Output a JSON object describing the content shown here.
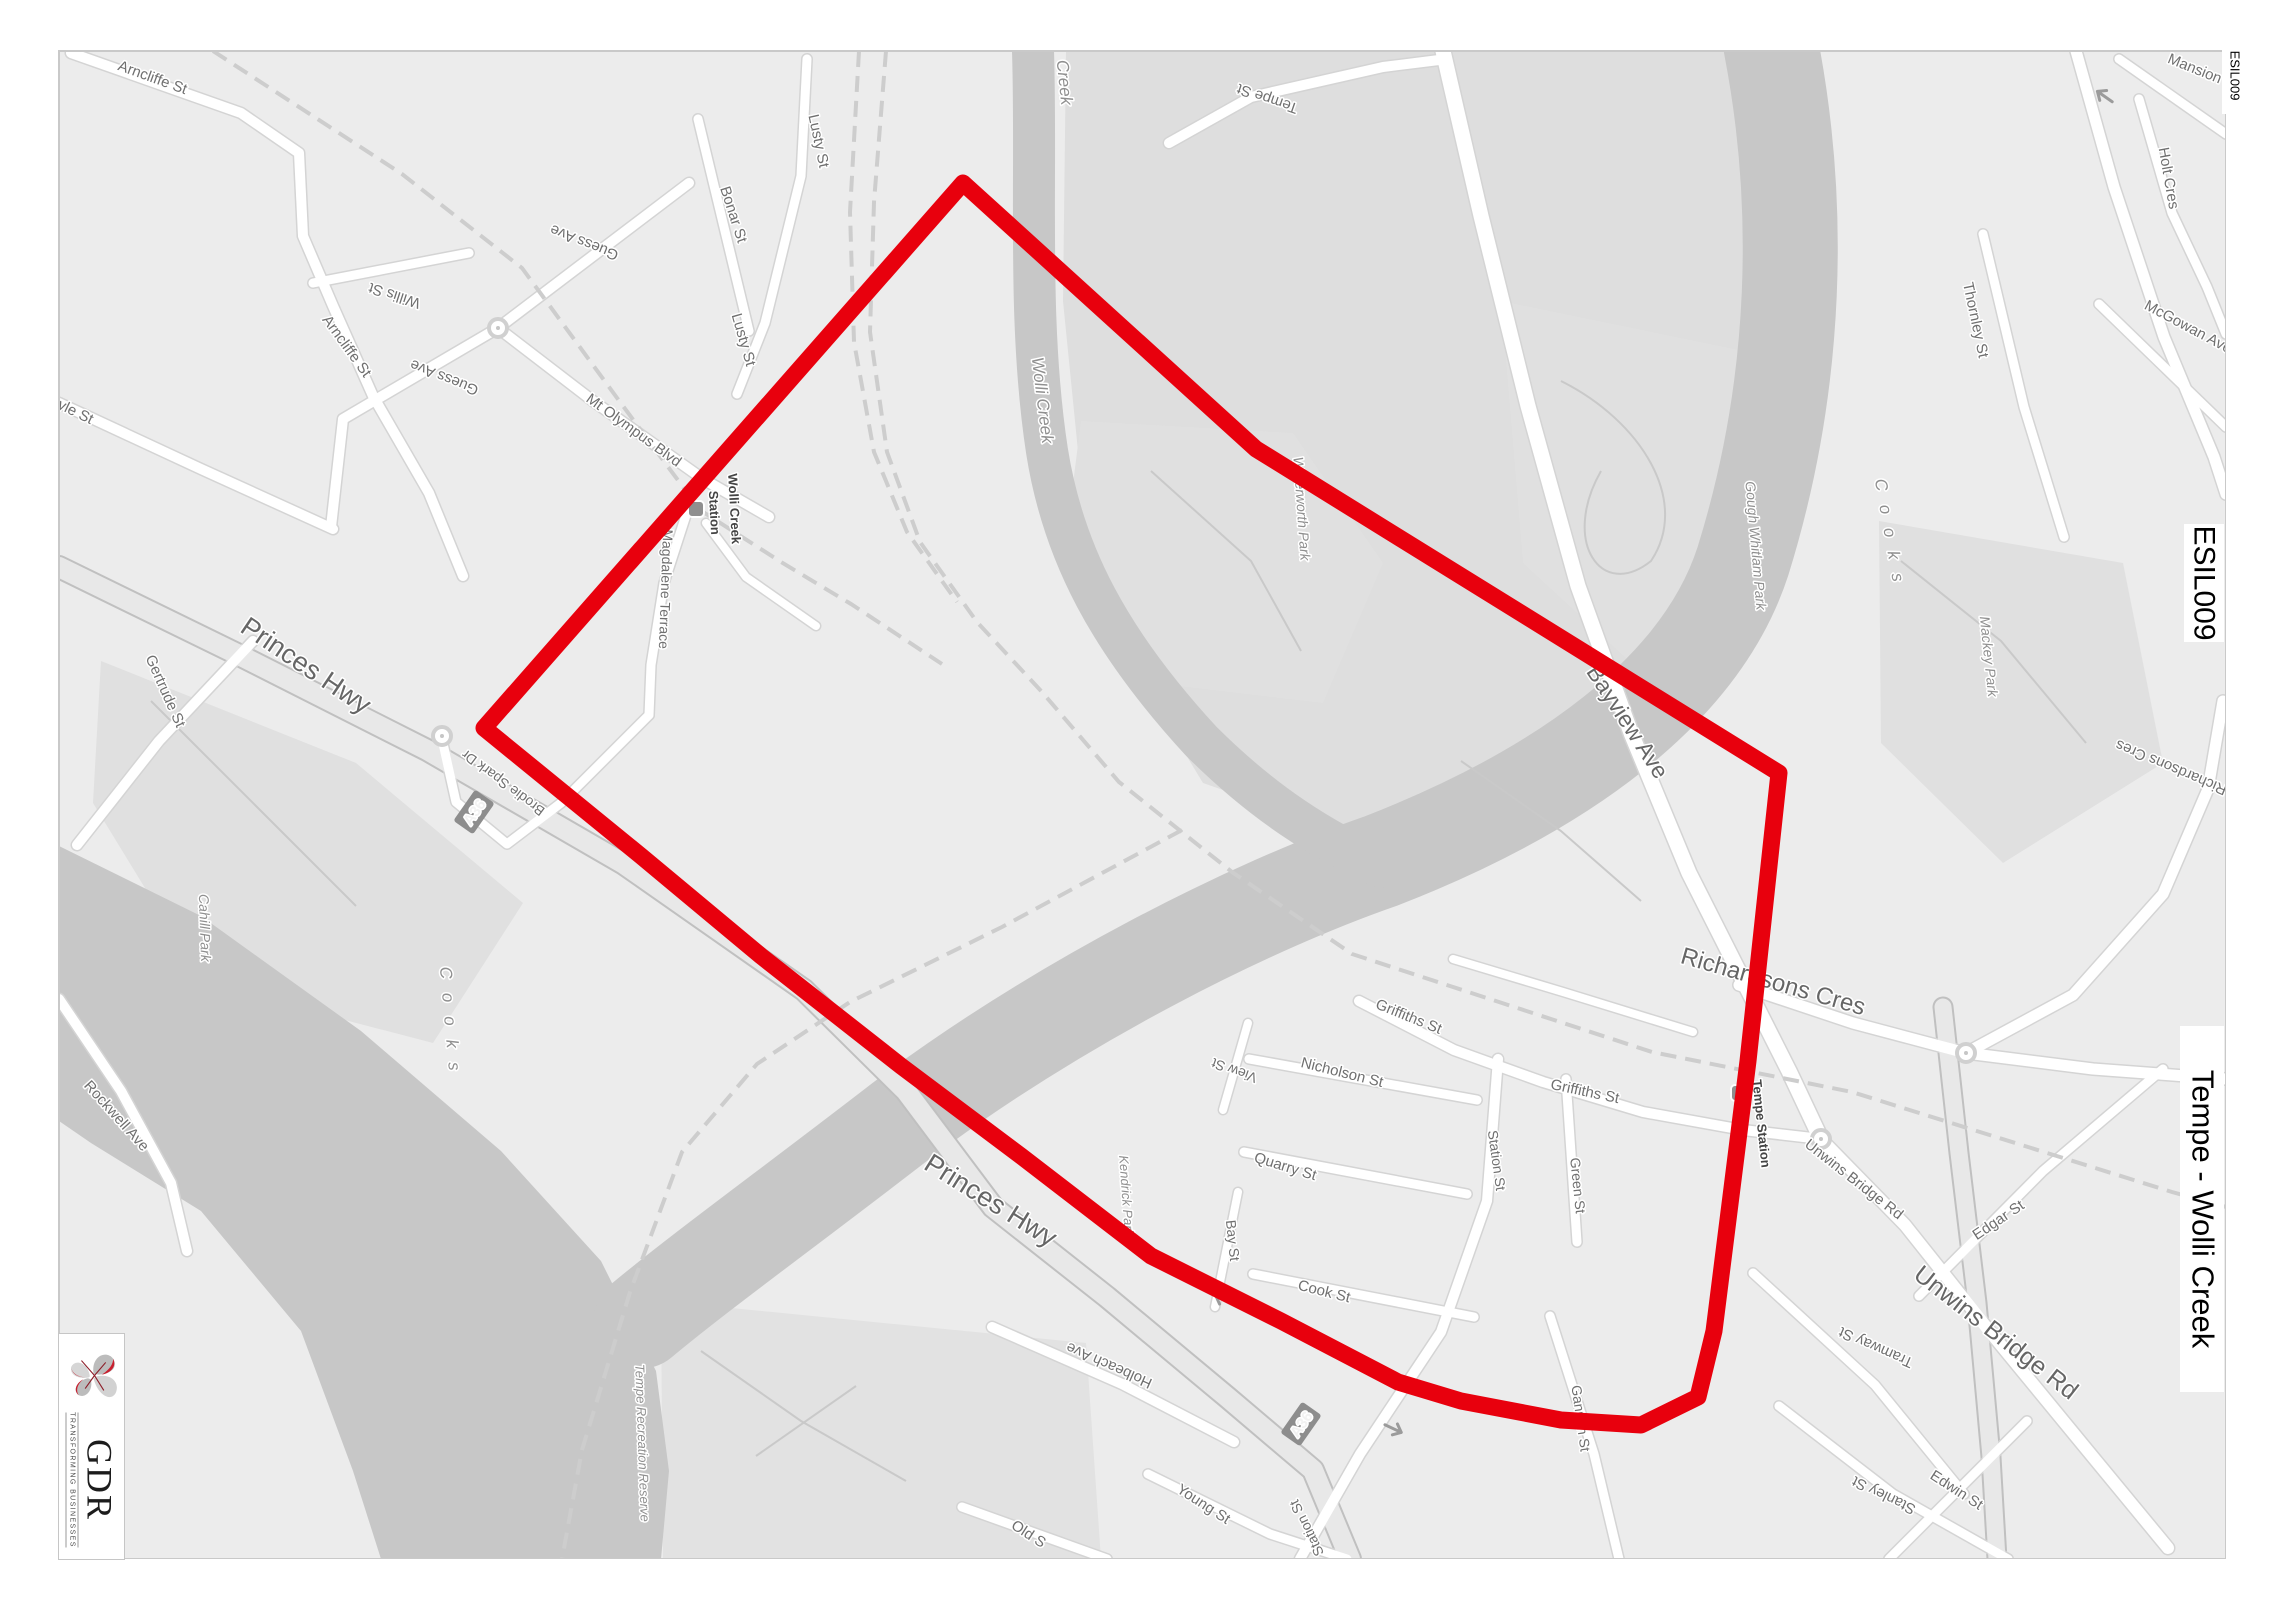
{
  "document": {
    "type": "map-extract"
  },
  "overlays": {
    "corner_code": "ESIL009",
    "side_code": "ESIL009",
    "side_title": "Tempe - Wolli Creek"
  },
  "logo": {
    "monogram": "GDR",
    "tagline": "TRANSFORMING BUSINESSES",
    "accent_color": "#c8202f"
  },
  "selection": {
    "color": "#e8000d",
    "stroke_width": 17,
    "points": [
      [
        483,
        727
      ],
      [
        962,
        182
      ],
      [
        1255,
        448
      ],
      [
        1778,
        772
      ],
      [
        1747,
        1060
      ],
      [
        1713,
        1330
      ],
      [
        1697,
        1396
      ],
      [
        1640,
        1424
      ],
      [
        1560,
        1419
      ],
      [
        1460,
        1400
      ],
      [
        1397,
        1381
      ],
      [
        1280,
        1320
      ],
      [
        1150,
        1255
      ],
      [
        1020,
        1155
      ],
      [
        900,
        1065
      ],
      [
        760,
        955
      ],
      [
        640,
        855
      ],
      [
        483,
        727
      ]
    ]
  },
  "route_badges": [
    {
      "label": "A36",
      "x": 473,
      "y": 811,
      "rot": -55
    },
    {
      "label": "A36",
      "x": 1300,
      "y": 1423,
      "rot": -55
    }
  ],
  "map_icons": [
    {
      "name": "roundabout-icon",
      "x": 497,
      "y": 327
    },
    {
      "name": "roundabout-icon",
      "x": 441,
      "y": 735
    },
    {
      "name": "roundabout-icon",
      "x": 1820,
      "y": 1138
    },
    {
      "name": "roundabout-icon",
      "x": 1965,
      "y": 1052
    },
    {
      "name": "station-marker-icon",
      "x": 695,
      "y": 508
    },
    {
      "name": "station-marker-icon",
      "x": 1738,
      "y": 1092
    },
    {
      "name": "oneway-arrow-icon",
      "x": 2103,
      "y": 95,
      "rot": 215
    },
    {
      "name": "oneway-arrow-icon",
      "x": 1222,
      "y": 1298,
      "rot": 205
    },
    {
      "name": "oneway-arrow-icon",
      "x": 1393,
      "y": 1428,
      "rot": 25
    }
  ],
  "map_labels": [
    {
      "t": "Arncliffe St",
      "x": 150,
      "y": 81,
      "r": 20,
      "s": 15
    },
    {
      "t": "Arncliffe St",
      "x": 342,
      "y": 348,
      "r": 54,
      "s": 15
    },
    {
      "t": "Willis St",
      "x": 395,
      "y": 290,
      "r": 198,
      "s": 15
    },
    {
      "t": "Guess Ave",
      "x": 585,
      "y": 237,
      "r": 202,
      "s": 15
    },
    {
      "t": "Guess Ave",
      "x": 445,
      "y": 372,
      "r": 202,
      "s": 15
    },
    {
      "t": "Bonar St",
      "x": 728,
      "y": 215,
      "r": 72,
      "s": 15
    },
    {
      "t": "Lusty St",
      "x": 813,
      "y": 141,
      "r": 78,
      "s": 15
    },
    {
      "t": "Lusty St",
      "x": 738,
      "y": 340,
      "r": 74,
      "s": 15
    },
    {
      "t": "Mt Olympus Blvd",
      "x": 630,
      "y": 433,
      "r": 36,
      "s": 15
    },
    {
      "t": "Wolli Creek",
      "x": 729,
      "y": 508,
      "r": 87,
      "s": 13,
      "st": "station"
    },
    {
      "t": "Station",
      "x": 709,
      "y": 512,
      "r": 87,
      "s": 13,
      "st": "station"
    },
    {
      "t": "Magdalene Terrace",
      "x": 660,
      "y": 588,
      "r": 92,
      "s": 14
    },
    {
      "t": "Brodie Spark Dr",
      "x": 505,
      "y": 778,
      "r": 217,
      "s": 14
    },
    {
      "t": "Argyle St",
      "x": 62,
      "y": 410,
      "r": 26,
      "s": 15
    },
    {
      "t": "Gertrude St",
      "x": 160,
      "y": 692,
      "r": 66,
      "s": 15
    },
    {
      "t": "Princes Hwy",
      "x": 300,
      "y": 672,
      "r": 34,
      "s": 27,
      "st": "big"
    },
    {
      "t": "Princes Hwy",
      "x": 985,
      "y": 1207,
      "r": 32,
      "s": 27,
      "st": "big"
    },
    {
      "t": "Cahill Park",
      "x": 199,
      "y": 927,
      "r": 88,
      "s": 14,
      "st": "place"
    },
    {
      "t": "Cooks",
      "x": 444,
      "y": 1025,
      "r": 85,
      "s": 17,
      "st": "water",
      "ls": 14
    },
    {
      "t": "Rockwell Ave",
      "x": 112,
      "y": 1118,
      "r": 48,
      "s": 15
    },
    {
      "t": "Creek",
      "x": 1058,
      "y": 82,
      "r": 84,
      "s": 17,
      "st": "water"
    },
    {
      "t": "Wolli Creek",
      "x": 1036,
      "y": 400,
      "r": 83,
      "s": 17,
      "st": "water"
    },
    {
      "t": "Tempe St",
      "x": 1268,
      "y": 93,
      "r": 199,
      "s": 15
    },
    {
      "t": "Waterworth Park",
      "x": 1296,
      "y": 508,
      "r": 86,
      "s": 14,
      "st": "place"
    },
    {
      "t": "Gough Whitlam Park",
      "x": 1750,
      "y": 545,
      "r": 85,
      "s": 14,
      "st": "place"
    },
    {
      "t": "Mackey Park",
      "x": 1983,
      "y": 656,
      "r": 84,
      "s": 14,
      "st": "place"
    },
    {
      "t": "Bayview Ave",
      "x": 1620,
      "y": 725,
      "r": 57,
      "s": 23,
      "st": "big"
    },
    {
      "t": "Richardsons Cres",
      "x": 1770,
      "y": 988,
      "r": 16,
      "s": 24,
      "st": "big"
    },
    {
      "t": "Richardsons Cres",
      "x": 2172,
      "y": 762,
      "r": 203,
      "s": 15
    },
    {
      "t": "Thornley St",
      "x": 1970,
      "y": 320,
      "r": 78,
      "s": 15
    },
    {
      "t": "McGowan Ave",
      "x": 2185,
      "y": 330,
      "r": 28,
      "s": 15
    },
    {
      "t": "Holt Cres",
      "x": 2163,
      "y": 178,
      "r": 80,
      "s": 15
    },
    {
      "t": "Mansion",
      "x": 2192,
      "y": 72,
      "r": 22,
      "s": 15
    },
    {
      "t": "Cooks",
      "x": 1884,
      "y": 537,
      "r": 80,
      "s": 17,
      "st": "water",
      "ls": 14
    },
    {
      "t": "Griffiths St",
      "x": 1406,
      "y": 1020,
      "r": 22,
      "s": 15
    },
    {
      "t": "Griffiths St",
      "x": 1583,
      "y": 1095,
      "r": 12,
      "s": 15
    },
    {
      "t": "View St",
      "x": 1235,
      "y": 1065,
      "r": 200,
      "s": 14
    },
    {
      "t": "Nicholson St",
      "x": 1340,
      "y": 1076,
      "r": 14,
      "s": 15
    },
    {
      "t": "Quarry St",
      "x": 1283,
      "y": 1170,
      "r": 17,
      "s": 15
    },
    {
      "t": "Bay St",
      "x": 1227,
      "y": 1240,
      "r": 84,
      "s": 14
    },
    {
      "t": "Cook St",
      "x": 1322,
      "y": 1295,
      "r": 14,
      "s": 15
    },
    {
      "t": "Station St",
      "x": 1491,
      "y": 1160,
      "r": 82,
      "s": 14
    },
    {
      "t": "Green St",
      "x": 1572,
      "y": 1185,
      "r": 84,
      "s": 14
    },
    {
      "t": "Gannon St",
      "x": 1575,
      "y": 1418,
      "r": 82,
      "s": 14
    },
    {
      "t": "Station St",
      "x": 1310,
      "y": 1525,
      "r": 244,
      "s": 14
    },
    {
      "t": "Young St",
      "x": 1200,
      "y": 1507,
      "r": 33,
      "s": 15
    },
    {
      "t": "Old S",
      "x": 1025,
      "y": 1537,
      "r": 33,
      "s": 15
    },
    {
      "t": "Holbeach Ave",
      "x": 1110,
      "y": 1360,
      "r": 204,
      "s": 15
    },
    {
      "t": "Kendrick Park",
      "x": 1121,
      "y": 1195,
      "r": 86,
      "s": 13,
      "st": "place"
    },
    {
      "t": "Tempe Recreation Reserve",
      "x": 637,
      "y": 1442,
      "r": 88,
      "s": 13,
      "st": "place"
    },
    {
      "t": "Tempe Station",
      "x": 1756,
      "y": 1123,
      "r": 84,
      "s": 13,
      "st": "station"
    },
    {
      "t": "Unwins Bridge Rd",
      "x": 1850,
      "y": 1182,
      "r": 38,
      "s": 15
    },
    {
      "t": "Unwins Bridge Rd",
      "x": 1990,
      "y": 1338,
      "r": 38,
      "s": 25,
      "st": "big"
    },
    {
      "t": "Edgar St",
      "x": 2000,
      "y": 1223,
      "r": -34,
      "s": 15
    },
    {
      "t": "Tramway St",
      "x": 1877,
      "y": 1342,
      "r": 204,
      "s": 15
    },
    {
      "t": "Stanley St",
      "x": 1885,
      "y": 1490,
      "r": 206,
      "s": 15
    },
    {
      "t": "Edwin St",
      "x": 1953,
      "y": 1493,
      "r": 33,
      "s": 15
    }
  ]
}
